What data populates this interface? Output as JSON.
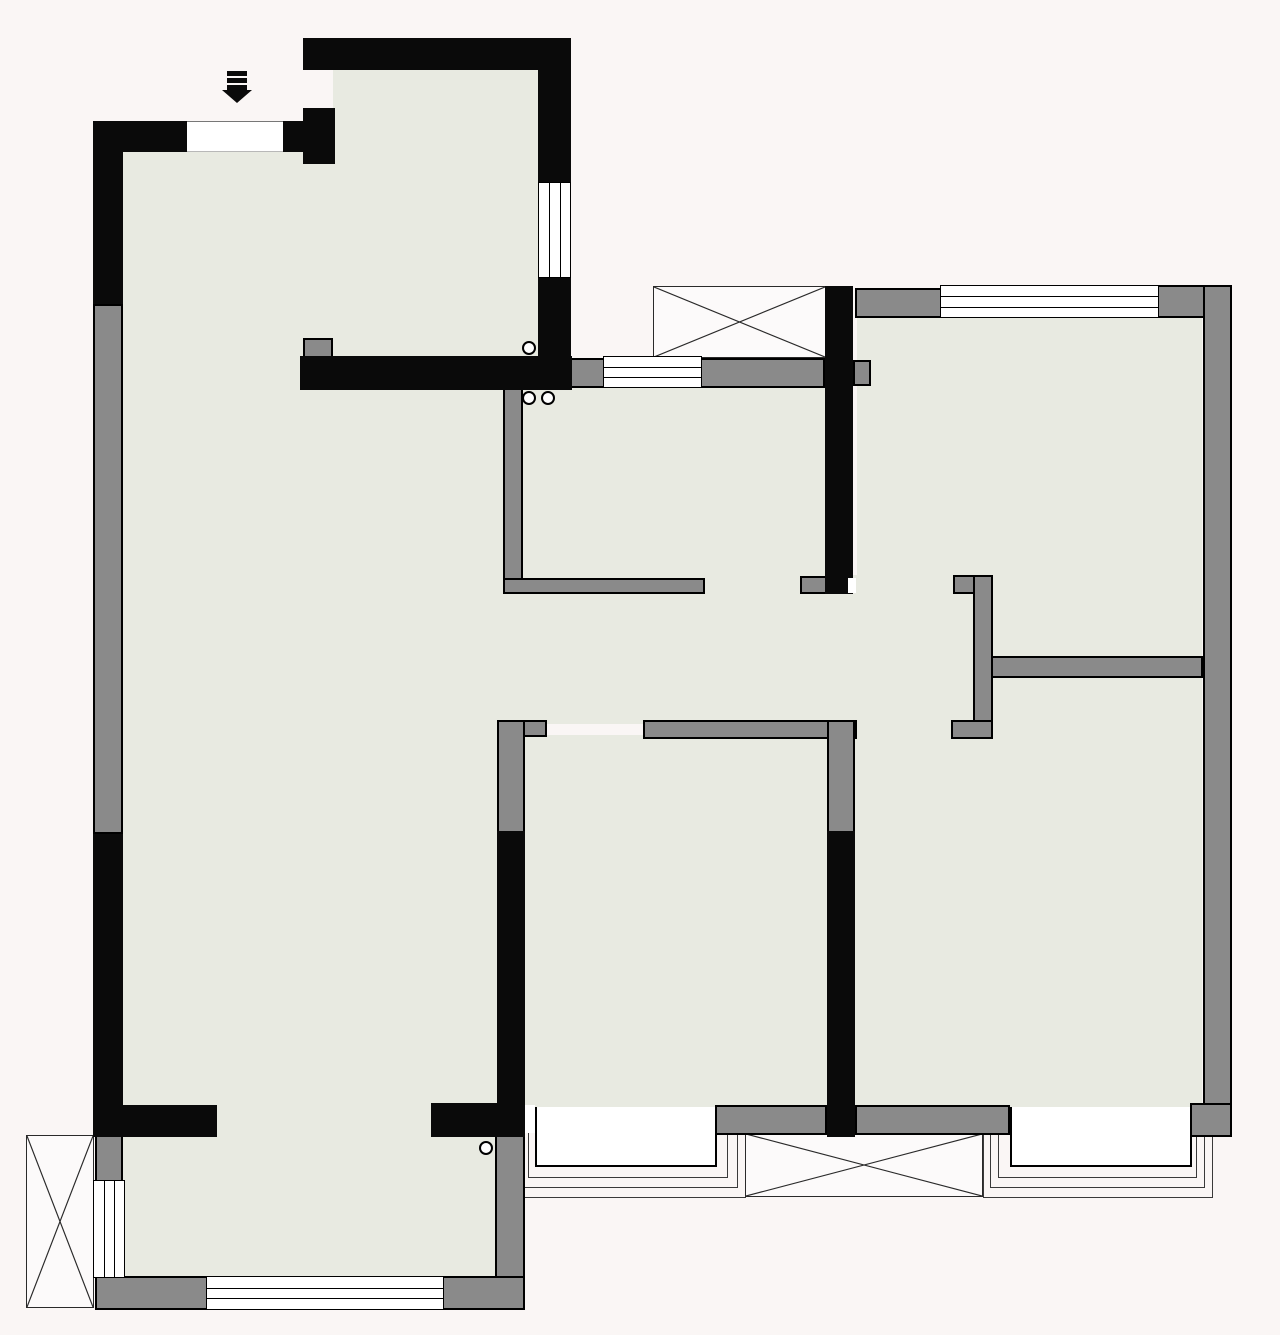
{
  "meta": {
    "title": "apartment-floor-plan",
    "canvas": {
      "w": 1280,
      "h": 1335
    },
    "colors": {
      "background": "#faf6f5",
      "floor": "#e8eae1",
      "wall_black": "#0a0a0a",
      "wall_gray": "#8a8a8a",
      "window_white": "#ffffff",
      "line": "#2a2a2a"
    }
  },
  "plan": {
    "floors": [
      {
        "name": "entry-hall-floor",
        "x": 333,
        "y": 68,
        "w": 205,
        "h": 292
      },
      {
        "name": "living-room-floor",
        "x": 123,
        "y": 150,
        "w": 387,
        "h": 957
      },
      {
        "name": "hallway-floor",
        "x": 505,
        "y": 592,
        "w": 470,
        "h": 132
      },
      {
        "name": "north-door-alcove-floor",
        "x": 853,
        "y": 575,
        "w": 104,
        "h": 20
      },
      {
        "name": "bedroom-north-floor",
        "x": 857,
        "y": 316,
        "w": 345,
        "h": 342
      },
      {
        "name": "kitchen-floor",
        "x": 521,
        "y": 386,
        "w": 306,
        "h": 196
      },
      {
        "name": "bedroom-south-floor",
        "x": 523,
        "y": 735,
        "w": 304,
        "h": 372
      },
      {
        "name": "bedroom-southeast-floor",
        "x": 855,
        "y": 675,
        "w": 347,
        "h": 432
      },
      {
        "name": "sunroom-floor",
        "x": 123,
        "y": 1133,
        "w": 374,
        "h": 147
      },
      {
        "name": "sunroom-passage-floor",
        "x": 215,
        "y": 1103,
        "w": 218,
        "h": 34
      },
      {
        "name": "kitchen-door-gap-floor",
        "x": 703,
        "y": 576,
        "w": 99,
        "h": 18
      },
      {
        "name": "se-door-gap-floor",
        "x": 855,
        "y": 718,
        "w": 99,
        "h": 21
      }
    ],
    "black_walls": [
      {
        "name": "left-wall-upper-black",
        "x": 93,
        "y": 121,
        "w": 30,
        "h": 183
      },
      {
        "name": "left-wall-lower-black",
        "x": 93,
        "y": 834,
        "w": 30,
        "h": 303
      },
      {
        "name": "entry-wall-left-black",
        "x": 93,
        "y": 121,
        "w": 96,
        "h": 31
      },
      {
        "name": "entry-wall-right-black",
        "x": 281,
        "y": 121,
        "w": 54,
        "h": 31
      },
      {
        "name": "entry-corner-post-black",
        "x": 303,
        "y": 108,
        "w": 32,
        "h": 56
      },
      {
        "name": "entry-hall-top-wall-black",
        "x": 303,
        "y": 38,
        "w": 268,
        "h": 32
      },
      {
        "name": "entry-hall-right-wall-upper",
        "x": 538,
        "y": 38,
        "w": 33,
        "h": 146
      },
      {
        "name": "entry-hall-right-wall-lower",
        "x": 538,
        "y": 276,
        "w": 33,
        "h": 114
      },
      {
        "name": "kitchen-top-wall-black",
        "x": 300,
        "y": 356,
        "w": 272,
        "h": 34
      },
      {
        "name": "kitchen-bedroom-divider-black",
        "x": 825,
        "y": 286,
        "w": 28,
        "h": 308
      },
      {
        "name": "bedroom-south-west-wall-black",
        "x": 497,
        "y": 831,
        "w": 28,
        "h": 276
      },
      {
        "name": "bedroom-south-east-wall-black",
        "x": 827,
        "y": 831,
        "w": 28,
        "h": 306
      },
      {
        "name": "sunroom-divider-left-black",
        "x": 93,
        "y": 1105,
        "w": 124,
        "h": 32
      },
      {
        "name": "sunroom-divider-right-black",
        "x": 431,
        "y": 1103,
        "w": 94,
        "h": 34
      }
    ],
    "gray_walls": [
      {
        "name": "left-wall-middle-gray",
        "x": 93,
        "y": 304,
        "w": 30,
        "h": 530
      },
      {
        "name": "entry-jamb-left-gray",
        "x": 124,
        "y": 123,
        "w": 63,
        "h": 29
      },
      {
        "name": "entry-jamb-right-gray",
        "x": 281,
        "y": 123,
        "w": 24,
        "h": 29
      },
      {
        "name": "entry-corner-cap-gray",
        "x": 305,
        "y": 151,
        "w": 28,
        "h": 12
      },
      {
        "name": "entry-hall-window-jamb-top",
        "x": 543,
        "y": 68,
        "w": 25,
        "h": 114
      },
      {
        "name": "entry-hall-window-jamb-bot",
        "x": 543,
        "y": 278,
        "w": 25,
        "h": 80
      },
      {
        "name": "kitchen-corner-jamb-gray",
        "x": 303,
        "y": 338,
        "w": 30,
        "h": 20
      },
      {
        "name": "kitchen-window-jamb-left",
        "x": 568,
        "y": 358,
        "w": 37,
        "h": 30
      },
      {
        "name": "kitchen-top-wall-gray",
        "x": 700,
        "y": 358,
        "w": 125,
        "h": 30
      },
      {
        "name": "bedroom-north-wall-nib",
        "x": 853,
        "y": 360,
        "w": 18,
        "h": 26
      },
      {
        "name": "bedroom-north-top-wall-gray",
        "x": 855,
        "y": 288,
        "w": 87,
        "h": 30
      },
      {
        "name": "northeast-corner-gray",
        "x": 1157,
        "y": 285,
        "w": 75,
        "h": 33
      },
      {
        "name": "right-outer-wall-gray",
        "x": 1203,
        "y": 285,
        "w": 29,
        "h": 852
      },
      {
        "name": "kitchen-west-wall-gray",
        "x": 503,
        "y": 386,
        "w": 20,
        "h": 206
      },
      {
        "name": "kitchen-south-wall-gray",
        "x": 503,
        "y": 578,
        "w": 202,
        "h": 16
      },
      {
        "name": "kitchen-door-cap-gray",
        "x": 800,
        "y": 576,
        "w": 27,
        "h": 18
      },
      {
        "name": "north-door-jamb-hook",
        "x": 953,
        "y": 575,
        "w": 40,
        "h": 19
      },
      {
        "name": "room-divider-vertical-gray",
        "x": 973,
        "y": 575,
        "w": 20,
        "h": 164
      },
      {
        "name": "south-door-jamb-hook",
        "x": 951,
        "y": 720,
        "w": 42,
        "h": 19
      },
      {
        "name": "room-divider-horizontal",
        "x": 991,
        "y": 656,
        "w": 212,
        "h": 22
      },
      {
        "name": "bedroom-south-top-wall",
        "x": 643,
        "y": 720,
        "w": 214,
        "h": 19
      },
      {
        "name": "bedroom-south-west-hook",
        "x": 497,
        "y": 720,
        "w": 50,
        "h": 17
      },
      {
        "name": "bedroom-south-west-gray",
        "x": 497,
        "y": 720,
        "w": 28,
        "h": 113
      },
      {
        "name": "bedroom-south-east-gray",
        "x": 827,
        "y": 720,
        "w": 28,
        "h": 113
      },
      {
        "name": "sunroom-divider-cap-gray",
        "x": 203,
        "y": 1108,
        "w": 14,
        "h": 26
      },
      {
        "name": "bedroom-south-bottom-gray",
        "x": 715,
        "y": 1105,
        "w": 112,
        "h": 30
      },
      {
        "name": "bedroom-se-bottom-gray",
        "x": 855,
        "y": 1105,
        "w": 155,
        "h": 30
      },
      {
        "name": "southeast-corner-gray",
        "x": 1190,
        "y": 1103,
        "w": 42,
        "h": 34
      },
      {
        "name": "sunroom-left-block-gray",
        "x": 95,
        "y": 1135,
        "w": 28,
        "h": 47
      },
      {
        "name": "southwest-corner-gray",
        "x": 95,
        "y": 1276,
        "w": 113,
        "h": 34
      },
      {
        "name": "sunroom-se-corner-gray",
        "x": 442,
        "y": 1276,
        "w": 83,
        "h": 34
      },
      {
        "name": "sunroom-east-wall-gray",
        "x": 495,
        "y": 1133,
        "w": 30,
        "h": 145
      }
    ],
    "windows": [
      {
        "name": "entrance-door-opening",
        "x": 187,
        "y": 121,
        "w": 96,
        "h": 31,
        "kind": "opening",
        "o": "h"
      },
      {
        "name": "entry-hall-east-window",
        "x": 538,
        "y": 182,
        "w": 33,
        "h": 96,
        "kind": "window",
        "o": "v"
      },
      {
        "name": "kitchen-north-window",
        "x": 603,
        "y": 356,
        "w": 99,
        "h": 32,
        "kind": "window",
        "o": "h"
      },
      {
        "name": "bedroom-north-window",
        "x": 940,
        "y": 285,
        "w": 219,
        "h": 33,
        "kind": "window",
        "o": "h"
      },
      {
        "name": "sunroom-west-window",
        "x": 93,
        "y": 1180,
        "w": 32,
        "h": 98,
        "kind": "window",
        "o": "v"
      },
      {
        "name": "sunroom-south-window",
        "x": 206,
        "y": 1276,
        "w": 238,
        "h": 34,
        "kind": "window",
        "o": "h"
      }
    ],
    "bay_windows": [
      {
        "name": "bedroom-south-bay-window",
        "x": 535,
        "y": 1105,
        "w": 182,
        "h": 62
      },
      {
        "name": "bedroom-se-bay-window",
        "x": 1010,
        "y": 1105,
        "w": 182,
        "h": 62
      }
    ],
    "sills": [
      {
        "name": "bay-south-sill-1",
        "x": 528,
        "y": 1105,
        "w": 200,
        "h": 73
      },
      {
        "name": "bay-south-sill-2",
        "x": 521,
        "y": 1105,
        "w": 217,
        "h": 83
      },
      {
        "name": "bay-south-sill-3",
        "x": 513,
        "y": 1105,
        "w": 233,
        "h": 93
      },
      {
        "name": "bay-se-sill-1",
        "x": 998,
        "y": 1105,
        "w": 199,
        "h": 73
      },
      {
        "name": "bay-se-sill-2",
        "x": 990,
        "y": 1105,
        "w": 215,
        "h": 83
      },
      {
        "name": "bay-se-sill-3",
        "x": 983,
        "y": 1105,
        "w": 230,
        "h": 93
      }
    ],
    "xboxes": [
      {
        "name": "flue-shaft-crossbox-top",
        "x": 653,
        "y": 286,
        "w": 173,
        "h": 72
      },
      {
        "name": "ac-platform-crossbox-left",
        "x": 26,
        "y": 1135,
        "w": 68,
        "h": 173
      },
      {
        "name": "ac-platform-crossbox-bottom",
        "x": 745,
        "y": 1133,
        "w": 238,
        "h": 64
      }
    ],
    "slits": [
      {
        "name": "door-leaf-slit-north",
        "x": 848,
        "y": 578,
        "w": 8,
        "h": 15
      },
      {
        "name": "door-leaf-slit-south",
        "x": 525,
        "y": 1105,
        "w": 10,
        "h": 28
      }
    ],
    "circles": [
      {
        "name": "drain-symbol-entry-hall",
        "cx": 529,
        "cy": 348,
        "r": 7
      },
      {
        "name": "drain-symbol-kitchen-1",
        "cx": 529,
        "cy": 398,
        "r": 7
      },
      {
        "name": "drain-symbol-kitchen-2",
        "cx": 548,
        "cy": 398,
        "r": 7
      },
      {
        "name": "drain-symbol-sunroom",
        "cx": 486,
        "cy": 1148,
        "r": 7
      }
    ],
    "entry_arrow": {
      "name": "entrance-arrow-icon",
      "bars": [
        {
          "x": 227,
          "y": 71,
          "w": 20,
          "h": 5
        },
        {
          "x": 227,
          "y": 78,
          "w": 20,
          "h": 5
        },
        {
          "x": 227,
          "y": 85,
          "w": 20,
          "h": 5
        }
      ],
      "head": {
        "x": 222,
        "y": 90,
        "w": 30,
        "h": 13
      }
    }
  }
}
